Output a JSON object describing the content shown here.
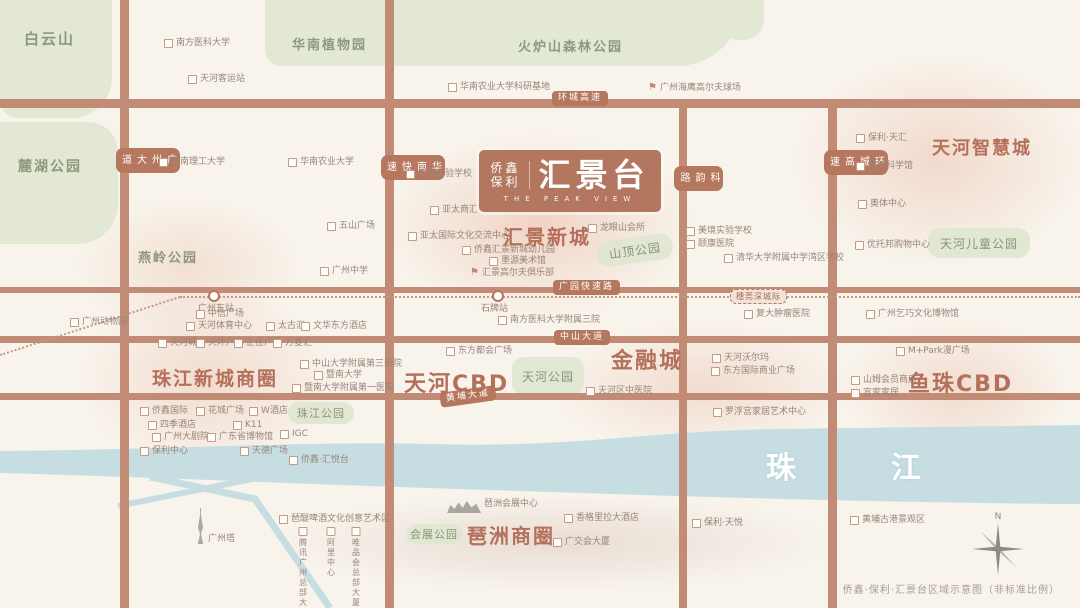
{
  "logo": {
    "brand_top": "侨鑫",
    "brand_bottom": "保利",
    "name": "汇景台",
    "subtitle": "THE PEAK VIEW"
  },
  "caption": "侨鑫·保利·汇景台区域示意图（非标准比例）",
  "compass_n": "N",
  "colors": {
    "background": "#f8f4ec",
    "road": "#c28b75",
    "road_badge": "#b5785f",
    "district_text": "#b4705a",
    "park_fill": "#e3e8d4",
    "park_text": "#84906f",
    "river": "#c6dee2",
    "poi_text": "#98857a",
    "logo_bg": "#b3765f"
  },
  "districts": [
    {
      "t": "汇景新城",
      "x": 503,
      "y": 221,
      "s": 20
    },
    {
      "t": "天河智慧城",
      "x": 932,
      "y": 134,
      "s": 18
    },
    {
      "t": "珠江新城商圈",
      "x": 152,
      "y": 364,
      "s": 19
    },
    {
      "t": "天河CBD",
      "x": 404,
      "y": 366,
      "s": 22
    },
    {
      "t": "金融城",
      "x": 611,
      "y": 343,
      "s": 22
    },
    {
      "t": "鱼珠CBD",
      "x": 908,
      "y": 366,
      "s": 22
    },
    {
      "t": "琶洲商圈",
      "x": 467,
      "y": 520,
      "s": 20
    }
  ],
  "area_labels": [
    {
      "t": "白云山",
      "x": 24,
      "y": 28,
      "s": 15
    },
    {
      "t": "麓湖公园",
      "x": 18,
      "y": 156,
      "s": 14
    },
    {
      "t": "华南植物园",
      "x": 292,
      "y": 34,
      "s": 13
    },
    {
      "t": "火炉山森林公园",
      "x": 518,
      "y": 36,
      "s": 13
    },
    {
      "t": "燕岭公园",
      "x": 138,
      "y": 247,
      "s": 13
    }
  ],
  "park_patches": [
    {
      "x": 0,
      "y": 0,
      "w": 112,
      "h": 118,
      "r": "0 0 40px 18px"
    },
    {
      "x": 0,
      "y": 122,
      "w": 118,
      "h": 122,
      "r": "0 30px 40px 0"
    },
    {
      "x": 265,
      "y": 0,
      "w": 478,
      "h": 66,
      "r": "0 0 120px 30px"
    },
    {
      "x": 718,
      "y": 0,
      "w": 46,
      "h": 40,
      "r": "0 0 20px 20px"
    }
  ],
  "park_boxes": [
    {
      "t": "山顶公园",
      "x": 597,
      "y": 237,
      "w": 76,
      "h": 26,
      "s": 12,
      "rot": -8
    },
    {
      "t": "天河儿童公园",
      "x": 928,
      "y": 228,
      "w": 102,
      "h": 30,
      "s": 12
    },
    {
      "t": "珠江公园",
      "x": 288,
      "y": 402,
      "w": 66,
      "h": 22,
      "s": 11
    },
    {
      "t": "天河公园",
      "x": 512,
      "y": 357,
      "w": 72,
      "h": 38,
      "s": 12
    },
    {
      "t": "会展公园",
      "x": 406,
      "y": 524,
      "w": 56,
      "h": 20,
      "s": 11
    }
  ],
  "roads": {
    "horizontal": [
      {
        "y": 99,
        "h": 9
      },
      {
        "y": 287,
        "h": 6
      },
      {
        "y": 336,
        "h": 7
      },
      {
        "y": 393,
        "h": 7
      }
    ],
    "vertical": [
      {
        "label": "广州大道",
        "x": 120,
        "w": 9,
        "ly": 148
      },
      {
        "label": "华南快速",
        "x": 385,
        "w": 9,
        "ly": 155
      },
      {
        "label": "科韵路",
        "x": 679,
        "w": 8,
        "ly": 166,
        "top": 99
      },
      {
        "label": "环城高速",
        "x": 828,
        "w": 9,
        "ly": 150,
        "top": 99
      }
    ],
    "badges": [
      {
        "t": "环城高速",
        "x": 552,
        "y": 91
      },
      {
        "t": "广园快速路",
        "x": 553,
        "y": 280
      },
      {
        "t": "中山大道",
        "x": 554,
        "y": 330
      },
      {
        "t": "黄埔大道",
        "x": 440,
        "y": 389,
        "rot": -8
      }
    ]
  },
  "metro": {
    "segments": [
      [
        0,
        354,
        180,
        296
      ],
      [
        180,
        296,
        1080,
        296
      ]
    ],
    "stations": [
      {
        "t": "广州东站",
        "x": 213,
        "y": 296,
        "lx": 198,
        "ly": 301
      },
      {
        "t": "石牌站",
        "x": 497,
        "y": 296,
        "lx": 481,
        "ly": 301
      }
    ],
    "badge": {
      "t": "穗莞深城际",
      "x": 730,
      "y": 289
    }
  },
  "river_labels": [
    {
      "t": "珠",
      "x": 766,
      "y": 443
    },
    {
      "t": "江",
      "x": 891,
      "y": 443
    }
  ],
  "pois": [
    {
      "t": "南方医科大学",
      "x": 164,
      "y": 39,
      "i": "school"
    },
    {
      "t": "天河客运站",
      "x": 188,
      "y": 75,
      "i": "station"
    },
    {
      "t": "华南理工大学",
      "x": 159,
      "y": 158,
      "i": "school"
    },
    {
      "t": "华南农业大学",
      "x": 288,
      "y": 158,
      "i": "school"
    },
    {
      "t": "华南农业大学科研基地",
      "x": 448,
      "y": 83,
      "i": "school"
    },
    {
      "t": "广州海鹰高尔夫球场",
      "x": 648,
      "y": 83,
      "i": "golf"
    },
    {
      "t": "汇景实验学校",
      "x": 406,
      "y": 170,
      "i": "school"
    },
    {
      "t": "五山广场",
      "x": 327,
      "y": 222
    },
    {
      "t": "广州中学",
      "x": 320,
      "y": 267,
      "i": "school"
    },
    {
      "t": "亚太商汇",
      "x": 430,
      "y": 206
    },
    {
      "t": "亚太国际文化交流中心",
      "x": 408,
      "y": 232
    },
    {
      "t": "侨鑫汇景新城幼儿园",
      "x": 462,
      "y": 246,
      "i": "school"
    },
    {
      "t": "汇景高尔夫俱乐部",
      "x": 470,
      "y": 268,
      "i": "golf"
    },
    {
      "t": "龙眼山会所",
      "x": 588,
      "y": 224
    },
    {
      "t": "墨源美术馆",
      "x": 489,
      "y": 257,
      "i": "museum"
    },
    {
      "t": "美境实验学校",
      "x": 686,
      "y": 227,
      "i": "school"
    },
    {
      "t": "颐康医院",
      "x": 686,
      "y": 240,
      "i": "hospital"
    },
    {
      "t": "清华大学附属中学湾区学校",
      "x": 724,
      "y": 254,
      "i": "school"
    },
    {
      "t": "保利·天汇",
      "x": 856,
      "y": 134
    },
    {
      "t": "航天科学馆",
      "x": 856,
      "y": 162,
      "i": "museum"
    },
    {
      "t": "奥体中心",
      "x": 858,
      "y": 200
    },
    {
      "t": "优托邦购物中心",
      "x": 855,
      "y": 241
    },
    {
      "t": "广州动物园",
      "x": 70,
      "y": 318,
      "i": "zoo"
    },
    {
      "t": "复大肿瘤医院",
      "x": 744,
      "y": 310,
      "i": "hospital"
    },
    {
      "t": "广州乞巧文化博物馆",
      "x": 866,
      "y": 310,
      "i": "museum"
    },
    {
      "t": "南方医科大学附属三院",
      "x": 498,
      "y": 316,
      "i": "hospital"
    },
    {
      "t": "中信广场",
      "x": 196,
      "y": 310
    },
    {
      "t": "天河体育中心",
      "x": 186,
      "y": 322
    },
    {
      "t": "太古汇",
      "x": 266,
      "y": 322
    },
    {
      "t": "文华东方酒店",
      "x": 301,
      "y": 322
    },
    {
      "t": "天河城",
      "x": 158,
      "y": 339
    },
    {
      "t": "天环广场",
      "x": 196,
      "y": 339
    },
    {
      "t": "正佳广场",
      "x": 234,
      "y": 339
    },
    {
      "t": "万菱汇",
      "x": 273,
      "y": 339
    },
    {
      "t": "中山大学附属第三医院",
      "x": 300,
      "y": 360,
      "i": "hospital"
    },
    {
      "t": "暨南大学",
      "x": 314,
      "y": 371,
      "i": "school"
    },
    {
      "t": "暨南大学附属第一医院",
      "x": 292,
      "y": 384,
      "i": "hospital"
    },
    {
      "t": "东方都会广场",
      "x": 446,
      "y": 347
    },
    {
      "t": "天河区中医院",
      "x": 586,
      "y": 387,
      "i": "hospital"
    },
    {
      "t": "天河沃尔玛",
      "x": 712,
      "y": 354
    },
    {
      "t": "东方国际商业广场",
      "x": 711,
      "y": 367
    },
    {
      "t": "M+Park漫广场",
      "x": 896,
      "y": 347
    },
    {
      "t": "山姆会员商店",
      "x": 851,
      "y": 376
    },
    {
      "t": "宜家家居",
      "x": 851,
      "y": 389
    },
    {
      "t": "罗浮宫家居艺术中心",
      "x": 713,
      "y": 408
    },
    {
      "t": "侨鑫国际",
      "x": 140,
      "y": 407
    },
    {
      "t": "花城广场",
      "x": 196,
      "y": 407
    },
    {
      "t": "W酒店",
      "x": 249,
      "y": 407
    },
    {
      "t": "四季酒店",
      "x": 148,
      "y": 421
    },
    {
      "t": "K11",
      "x": 233,
      "y": 421
    },
    {
      "t": "广州大剧院",
      "x": 152,
      "y": 433
    },
    {
      "t": "广东省博物馆",
      "x": 207,
      "y": 433
    },
    {
      "t": "IGC",
      "x": 280,
      "y": 430
    },
    {
      "t": "保利中心",
      "x": 140,
      "y": 447
    },
    {
      "t": "天德广场",
      "x": 240,
      "y": 447
    },
    {
      "t": "侨鑫·汇悦台",
      "x": 289,
      "y": 456
    },
    {
      "t": "琶醍啤酒文化创意艺术区",
      "x": 279,
      "y": 515
    },
    {
      "t": "腾讯广州\n总部大楼",
      "x": 303,
      "y": 527,
      "i": "stack"
    },
    {
      "t": "阿里\n中心",
      "x": 331,
      "y": 527,
      "i": "stack"
    },
    {
      "t": "唯品会\n总部大厦",
      "x": 356,
      "y": 527,
      "i": "stack"
    },
    {
      "t": "琶洲会展中心",
      "x": 447,
      "y": 500,
      "i": "canopy"
    },
    {
      "t": "香格里拉大酒店",
      "x": 564,
      "y": 514
    },
    {
      "t": "广交会大厦",
      "x": 553,
      "y": 538
    },
    {
      "t": "保利·天悦",
      "x": 692,
      "y": 519
    },
    {
      "t": "广州塔",
      "x": 196,
      "y": 508,
      "i": "tower"
    },
    {
      "t": "黄埔古港景观区",
      "x": 850,
      "y": 516
    }
  ]
}
